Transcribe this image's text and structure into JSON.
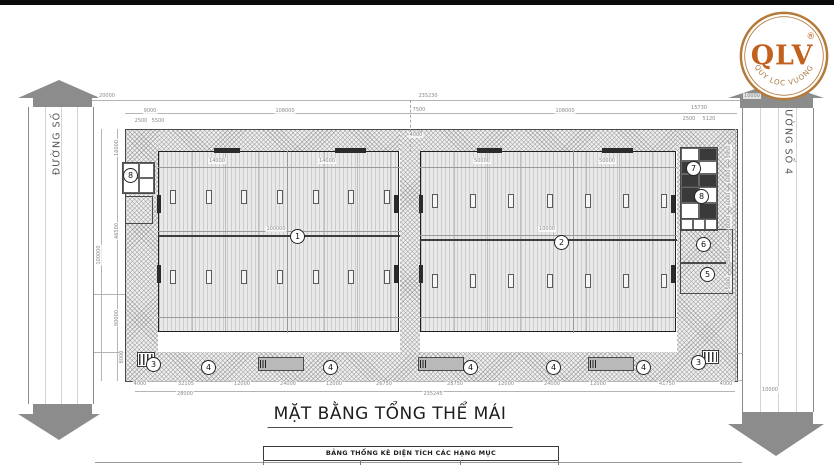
{
  "title": {
    "text": "MẶT BẰNG TỔNG THỂ MÁI"
  },
  "table": {
    "header": "BẢNG THỐNG KÊ DIỆN TÍCH CÁC HẠNG MỤC"
  },
  "logo": {
    "abbr": "QLV",
    "registered": "®",
    "tagline": "QUY LOC VUONG",
    "ring_color": "#b5793a",
    "text_color": "#c2611e"
  },
  "roads": {
    "left": {
      "label": "ĐƯỜNG SỐ 2"
    },
    "right": {
      "label": "ĐƯỜNG SỐ 4"
    }
  },
  "colors": {
    "hatch_bg": "#efefef",
    "roof_bg": "#e9e9e9",
    "road_gray": "#8c8c8c",
    "dark_line": "#2b2b2b",
    "dim_text": "#8a8a8a"
  },
  "drawing": {
    "markers": [
      {
        "n": "1",
        "x": 297,
        "y": 236
      },
      {
        "n": "2",
        "x": 561,
        "y": 242
      },
      {
        "n": "8",
        "x": 130,
        "y": 175
      },
      {
        "n": "7",
        "x": 693,
        "y": 168
      },
      {
        "n": "8",
        "x": 701,
        "y": 196
      },
      {
        "n": "6",
        "x": 703,
        "y": 244
      },
      {
        "n": "5",
        "x": 707,
        "y": 274
      },
      {
        "n": "3",
        "x": 153,
        "y": 364
      },
      {
        "n": "4",
        "x": 208,
        "y": 367
      },
      {
        "n": "4",
        "x": 330,
        "y": 367
      },
      {
        "n": "4",
        "x": 470,
        "y": 367
      },
      {
        "n": "4",
        "x": 553,
        "y": 367
      },
      {
        "n": "4",
        "x": 643,
        "y": 367
      },
      {
        "n": "3",
        "x": 698,
        "y": 362
      }
    ],
    "dim_labels": [
      {
        "t": "20000",
        "x": 107,
        "y": 96,
        "r": 0
      },
      {
        "t": "235230",
        "x": 428,
        "y": 96,
        "r": 0
      },
      {
        "t": "10000",
        "x": 752,
        "y": 96,
        "r": 0
      },
      {
        "t": "9000",
        "x": 150,
        "y": 111,
        "r": 0
      },
      {
        "t": "2500",
        "x": 141,
        "y": 121,
        "r": 0
      },
      {
        "t": "5500",
        "x": 158,
        "y": 121,
        "r": 0
      },
      {
        "t": "108000",
        "x": 285,
        "y": 111,
        "r": 0
      },
      {
        "t": "7500",
        "x": 419,
        "y": 110,
        "r": 0
      },
      {
        "t": "4000",
        "x": 416,
        "y": 135,
        "r": 0
      },
      {
        "t": "108000",
        "x": 565,
        "y": 111,
        "r": 0
      },
      {
        "t": "15730",
        "x": 699,
        "y": 108,
        "r": 0
      },
      {
        "t": "2500",
        "x": 689,
        "y": 119,
        "r": 0
      },
      {
        "t": "5120",
        "x": 709,
        "y": 119,
        "r": 0
      },
      {
        "t": "14000",
        "x": 217,
        "y": 161,
        "r": 0
      },
      {
        "t": "14000",
        "x": 327,
        "y": 161,
        "r": 0
      },
      {
        "t": "50000",
        "x": 482,
        "y": 161,
        "r": 0
      },
      {
        "t": "50000",
        "x": 607,
        "y": 161,
        "r": 0
      },
      {
        "t": "100000",
        "x": 276,
        "y": 229,
        "r": 0
      },
      {
        "t": "10000",
        "x": 547,
        "y": 229,
        "r": 0
      },
      {
        "t": "16000",
        "x": 117,
        "y": 148,
        "r": 1
      },
      {
        "t": "46500",
        "x": 117,
        "y": 231,
        "r": 1
      },
      {
        "t": "100000",
        "x": 99,
        "y": 255,
        "r": 1
      },
      {
        "t": "80000",
        "x": 117,
        "y": 318,
        "r": 1
      },
      {
        "t": "8000",
        "x": 122,
        "y": 357,
        "r": 1
      },
      {
        "t": "3950",
        "x": 729,
        "y": 152,
        "r": 1
      },
      {
        "t": "6000",
        "x": 729,
        "y": 176,
        "r": 1
      },
      {
        "t": "6000",
        "x": 729,
        "y": 199,
        "r": 1
      },
      {
        "t": "8000",
        "x": 729,
        "y": 222,
        "r": 1
      },
      {
        "t": "30000",
        "x": 729,
        "y": 255,
        "r": 1
      },
      {
        "t": "5000",
        "x": 729,
        "y": 283,
        "r": 1
      },
      {
        "t": "10000",
        "x": 770,
        "y": 390,
        "r": 0
      },
      {
        "t": "4000",
        "x": 140,
        "y": 384,
        "r": 0
      },
      {
        "t": "32105",
        "x": 186,
        "y": 384,
        "r": 0
      },
      {
        "t": "12000",
        "x": 242,
        "y": 384,
        "r": 0
      },
      {
        "t": "24000",
        "x": 288,
        "y": 384,
        "r": 0
      },
      {
        "t": "12000",
        "x": 334,
        "y": 384,
        "r": 0
      },
      {
        "t": "26750",
        "x": 384,
        "y": 384,
        "r": 0
      },
      {
        "t": "28750",
        "x": 455,
        "y": 384,
        "r": 0
      },
      {
        "t": "12000",
        "x": 506,
        "y": 384,
        "r": 0
      },
      {
        "t": "24000",
        "x": 552,
        "y": 384,
        "r": 0
      },
      {
        "t": "12000",
        "x": 598,
        "y": 384,
        "r": 0
      },
      {
        "t": "41750",
        "x": 667,
        "y": 384,
        "r": 0
      },
      {
        "t": "4000",
        "x": 726,
        "y": 384,
        "r": 0
      },
      {
        "t": "28000",
        "x": 185,
        "y": 394,
        "r": 0
      },
      {
        "t": "235245",
        "x": 433,
        "y": 394,
        "r": 0
      }
    ]
  }
}
